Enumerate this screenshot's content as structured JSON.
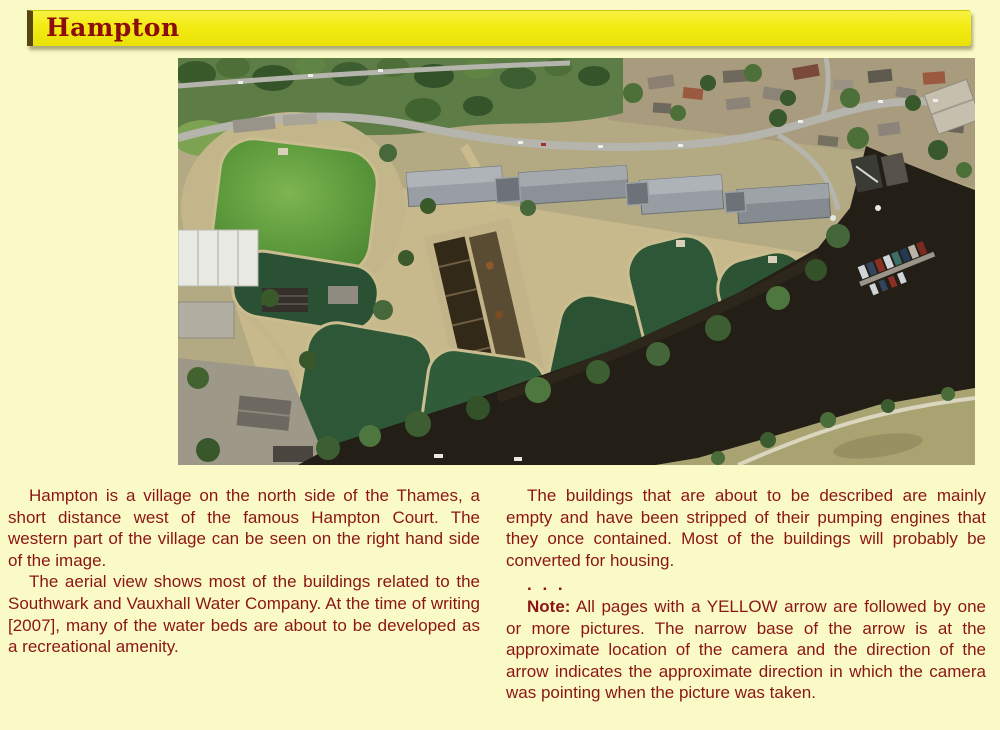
{
  "page": {
    "background_color": "#fafac6"
  },
  "header": {
    "title": "Hampton",
    "bar_color": "#f2eb12",
    "title_color": "#8b0d0d"
  },
  "photo": {
    "semantic": "aerial-photo-of-hampton-waterworks-and-thames",
    "palette": {
      "filter_beds_dark_green": "#2e5737",
      "reservoir_bright_green": "#5d9a3c",
      "river_thames": "#241f16",
      "tan_paths": "#c7b98c",
      "grass_field": "#a9a271",
      "roads": "#b5b5ad"
    }
  },
  "left_column": {
    "para1": "Hampton is a village on the north side of the Thames, a short distance west of the famous Hampton Court. The western part of the village can be seen on the right hand side of the image.",
    "para2": "The aerial view shows most of the buildings related to the Southwark and Vauxhall Water Company. At the time of writing [2007], many of the water beds are about to be developed as a recreational amenity."
  },
  "right_column": {
    "para1": "The buildings that are about to be described are mainly empty and have been stripped of their pumping engines that they once contained. Most of the buildings will probably be converted for housing.",
    "separator": ". . .",
    "note_label": "Note:",
    "note_text": "All pages with a YELLOW arrow are followed by one or more pictures. The narrow base of the arrow is at the approximate location of the camera and the direction of the arrow indicates the approximate direction in which the camera was pointing when the picture was taken."
  }
}
